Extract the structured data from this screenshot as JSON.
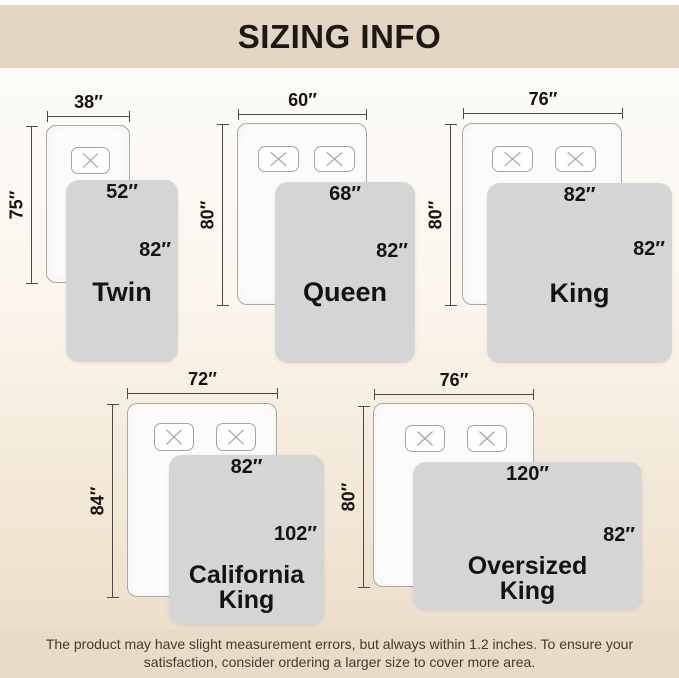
{
  "header": {
    "title": "SIZING INFO"
  },
  "beds": [
    {
      "id": "twin",
      "name_line1": "Twin",
      "bed_width": "38″",
      "bed_length": "75″",
      "blanket_width": "52″",
      "blanket_length": "82″"
    },
    {
      "id": "queen",
      "name_line1": "Queen",
      "bed_width": "60″",
      "bed_length": "80″",
      "blanket_width": "68″",
      "blanket_length": "82″"
    },
    {
      "id": "king",
      "name_line1": "King",
      "bed_width": "76″",
      "bed_length": "80″",
      "blanket_width": "82″",
      "blanket_length": "82″"
    },
    {
      "id": "california-king",
      "name_line1": "California",
      "name_line2": "King",
      "bed_width": "72″",
      "bed_length": "84″",
      "blanket_width": "82″",
      "blanket_length": "102″"
    },
    {
      "id": "oversized-king",
      "name_line1": "Oversized",
      "name_line2": "King",
      "bed_width": "76″",
      "bed_length": "80″",
      "blanket_width": "120″",
      "blanket_length": "82″"
    }
  ],
  "footer": {
    "line1": "The product may have slight measurement errors, but always within 1.2 inches. To ensure your",
    "line2": "satisfaction, consider ordering a larger size to cover more area."
  },
  "colors": {
    "band": "#e2d6c3",
    "blanket": "#d5d5d5",
    "bed_fill": "#fcfbfa",
    "dim_line": "#4a4a4a",
    "title_ink": "#1d1813",
    "footer_ink": "#453b2d"
  }
}
